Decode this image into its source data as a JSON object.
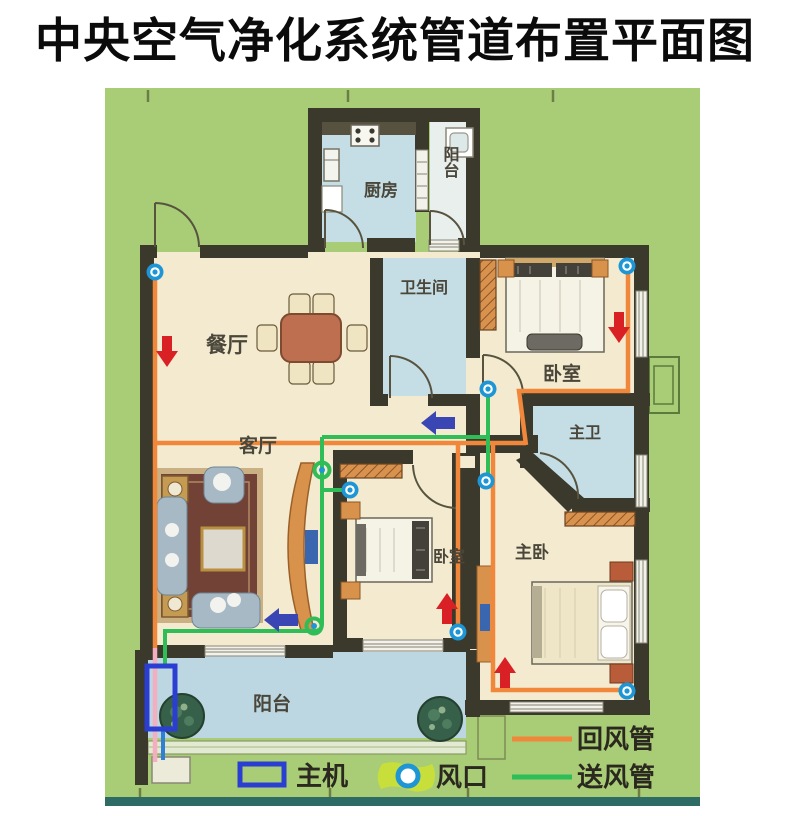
{
  "title": "中央空气净化系统管道布置平面图",
  "rooms": {
    "kitchen": "厨房",
    "balcony_top": "阳台",
    "bathroom": "卫生间",
    "dining": "餐厅",
    "living": "客厅",
    "bedroom_ne": "卧室",
    "master_bath": "主卫",
    "bedroom_mid": "卧室",
    "master_bedroom": "主卧",
    "balcony_bottom": "阳台"
  },
  "legend": {
    "main_unit": "主机",
    "vent": "风口",
    "return_duct": "回风管",
    "supply_duct": "送风管"
  },
  "colors": {
    "plan_background": "#a9cd76",
    "wall": "#3b382c",
    "floor_cream": "#f3ead0",
    "floor_blue": "#c5dee5",
    "balcony_blue": "#bcd7e2",
    "return_pipe_orange": "#f0873a",
    "return_pipe_faded_pink": "#f3aec2",
    "supply_pipe_green": "#2ebd57",
    "vent_blue": "#1e96d6",
    "vent_glow_yellow": "#c8df3b",
    "main_unit_blue": "#2b3ed2",
    "arrow_red": "#d92025",
    "arrow_blue": "#3a46b4",
    "bottom_border_teal": "#2f6b65"
  }
}
